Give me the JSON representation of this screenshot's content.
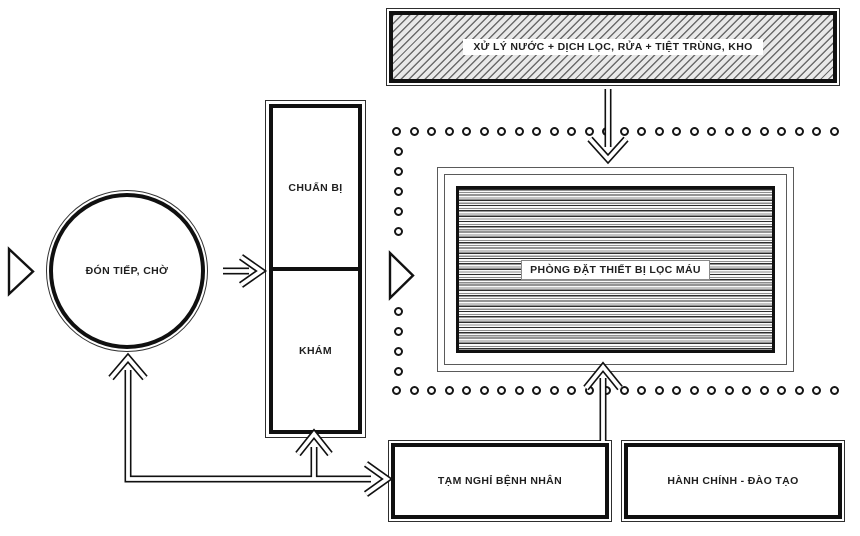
{
  "nodes": {
    "water_treatment": {
      "label": "XỬ LÝ NƯỚC + DỊCH LỌC, RỬA + TIỆT TRÙNG, KHO",
      "style": "hatched"
    },
    "reception_waiting": {
      "label": "ĐÓN TIẾP, CHỜ",
      "shape": "circle"
    },
    "preparation": {
      "label": "CHUẨN BỊ"
    },
    "examination": {
      "label": "KHÁM"
    },
    "dialysis_equipment_room": {
      "label": "PHÒNG ĐẶT THIẾT BỊ LỌC MÁU",
      "style": "horizontal-stripes",
      "boundary": "dotted"
    },
    "patient_rest": {
      "label": "TẠM NGHỈ BỆNH NHÂN"
    },
    "admin_training": {
      "label": "HÀNH CHÍNH - ĐÀO TẠO"
    }
  },
  "arrows": [
    {
      "name": "entrance-left",
      "type": "open-triangle",
      "direction": "right",
      "into": "reception_waiting"
    },
    {
      "name": "reception-to-preparation",
      "type": "block-arrow",
      "direction": "right"
    },
    {
      "name": "entrance-dotted-boundary",
      "type": "open-triangle",
      "direction": "right",
      "into": "dialysis_equipment_room"
    },
    {
      "name": "water-treatment-to-dialysis-room",
      "type": "block-arrow",
      "direction": "down"
    },
    {
      "name": "patient-rest-to-dialysis-room",
      "type": "block-arrow",
      "direction": "up"
    },
    {
      "name": "connector-to-reception",
      "type": "block-arrow",
      "direction": "up"
    },
    {
      "name": "connector-to-examination",
      "type": "block-arrow",
      "direction": "up"
    },
    {
      "name": "connector-to-patient-rest",
      "type": "block-arrow",
      "direction": "right"
    }
  ],
  "colors": {
    "line": "#111111",
    "background": "#ffffff",
    "hatch_fill": "#e9e9e9"
  }
}
